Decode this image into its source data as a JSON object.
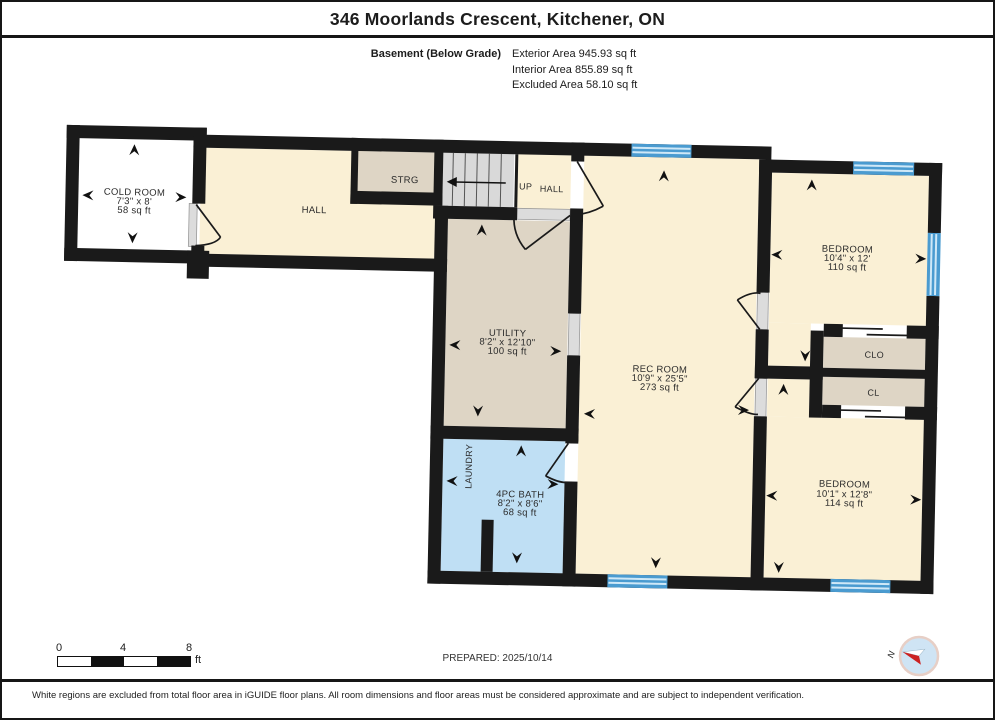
{
  "header": {
    "title": "346 Moorlands Crescent, Kitchener, ON",
    "floor_label": "Basement (Below Grade)",
    "area_lines": [
      "Exterior Area 945.93 sq ft",
      "Interior Area 855.89 sq ft",
      "Excluded Area 58.10 sq ft"
    ]
  },
  "rooms": {
    "cold_room": {
      "name": "COLD ROOM",
      "dims": "7'3\" x 8'",
      "area": "58 sq ft"
    },
    "hall": {
      "name": "HALL"
    },
    "strg": {
      "name": "STRG"
    },
    "stair_hall": {
      "name": "HALL",
      "up_label": "UP"
    },
    "utility": {
      "name": "UTILITY",
      "dims": "8'2\" x 12'10\"",
      "area": "100 sq ft"
    },
    "rec_room": {
      "name": "REC ROOM",
      "dims": "10'9\" x 25'5\"",
      "area": "273 sq ft"
    },
    "bedroom_top": {
      "name": "BEDROOM",
      "dims": "10'4\" x 12'",
      "area": "110 sq ft"
    },
    "closet_clo": {
      "name": "CLO"
    },
    "closet_cl": {
      "name": "CL"
    },
    "laundry": {
      "name": "LAUNDRY"
    },
    "bath": {
      "name": "4PC BATH",
      "dims": "8'2\" x 8'6\"",
      "area": "68 sq ft"
    },
    "bedroom_bottom": {
      "name": "BEDROOM",
      "dims": "10'1\" x 12'8\"",
      "area": "114 sq ft"
    }
  },
  "footer": {
    "disclaimer": "White regions are excluded from total floor area in iGUIDE floor plans. All room dimensions and floor areas must be considered approximate and are subject to independent verification.",
    "prepared": "PREPARED: 2025/10/14",
    "scale": {
      "ticks": [
        "0",
        "4",
        "8"
      ],
      "unit": "ft"
    },
    "compass_label": "N"
  },
  "colors": {
    "wall": "#1a1a1a",
    "floor_cream": "#faf0d5",
    "floor_taupe": "#ded5c5",
    "floor_blue": "#bfdff4",
    "stairs_gray": "#d9d9d9",
    "window_blue": "#4a9bd0",
    "excluded_white": "#ffffff",
    "compass_red": "#cc2222"
  }
}
